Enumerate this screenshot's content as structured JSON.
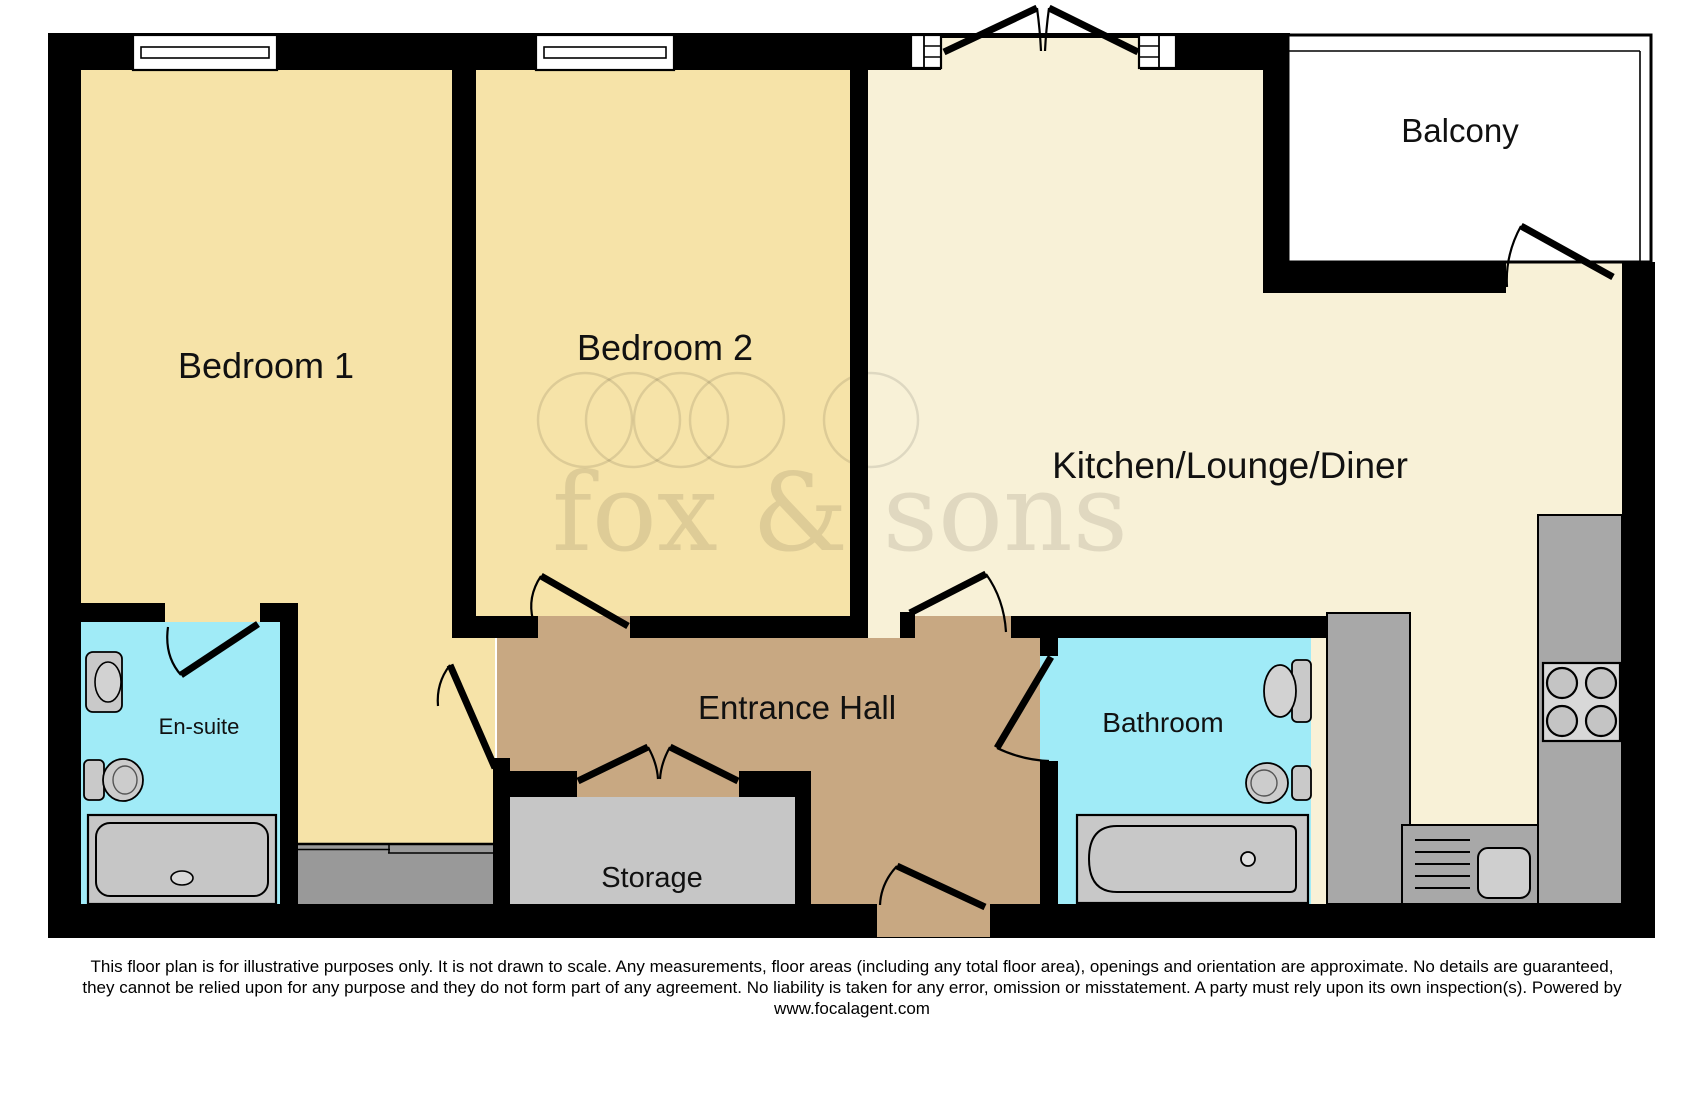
{
  "plan": {
    "rooms": {
      "bedroom1": {
        "label": "Bedroom 1"
      },
      "bedroom2": {
        "label": "Bedroom 2"
      },
      "kitchen": {
        "label": "Kitchen/Lounge/Diner"
      },
      "balcony": {
        "label": "Balcony"
      },
      "ensuite": {
        "label": "En-suite"
      },
      "hall": {
        "label": "Entrance Hall"
      },
      "bathroom": {
        "label": "Bathroom"
      },
      "storage": {
        "label": "Storage"
      }
    },
    "colors": {
      "wall": "#000000",
      "bedroom": "#f6e3a8",
      "kitchen": "#f8f1d7",
      "hall": "#c8a882",
      "wet_room": "#a0ebf7",
      "storage": "#c6c6c6",
      "wardrobe": "#999999",
      "counter": "#a8a8a8",
      "fixture": "#c9c9c9",
      "hob": "#d8d8d8",
      "balcony": "#ffffff"
    },
    "watermark": {
      "text": "fox & sons"
    }
  },
  "footer": {
    "line1": "This floor plan is for illustrative purposes only. It is not drawn to scale. Any measurements, floor areas (including any total floor area), openings and orientation are approximate. No details are guaranteed,",
    "line2": "they cannot be relied upon for any purpose and they do not form part of any agreement. No liability is taken for any error, omission or misstatement. A party must rely upon its own inspection(s). Powered by",
    "line3": "www.focalagent.com"
  }
}
